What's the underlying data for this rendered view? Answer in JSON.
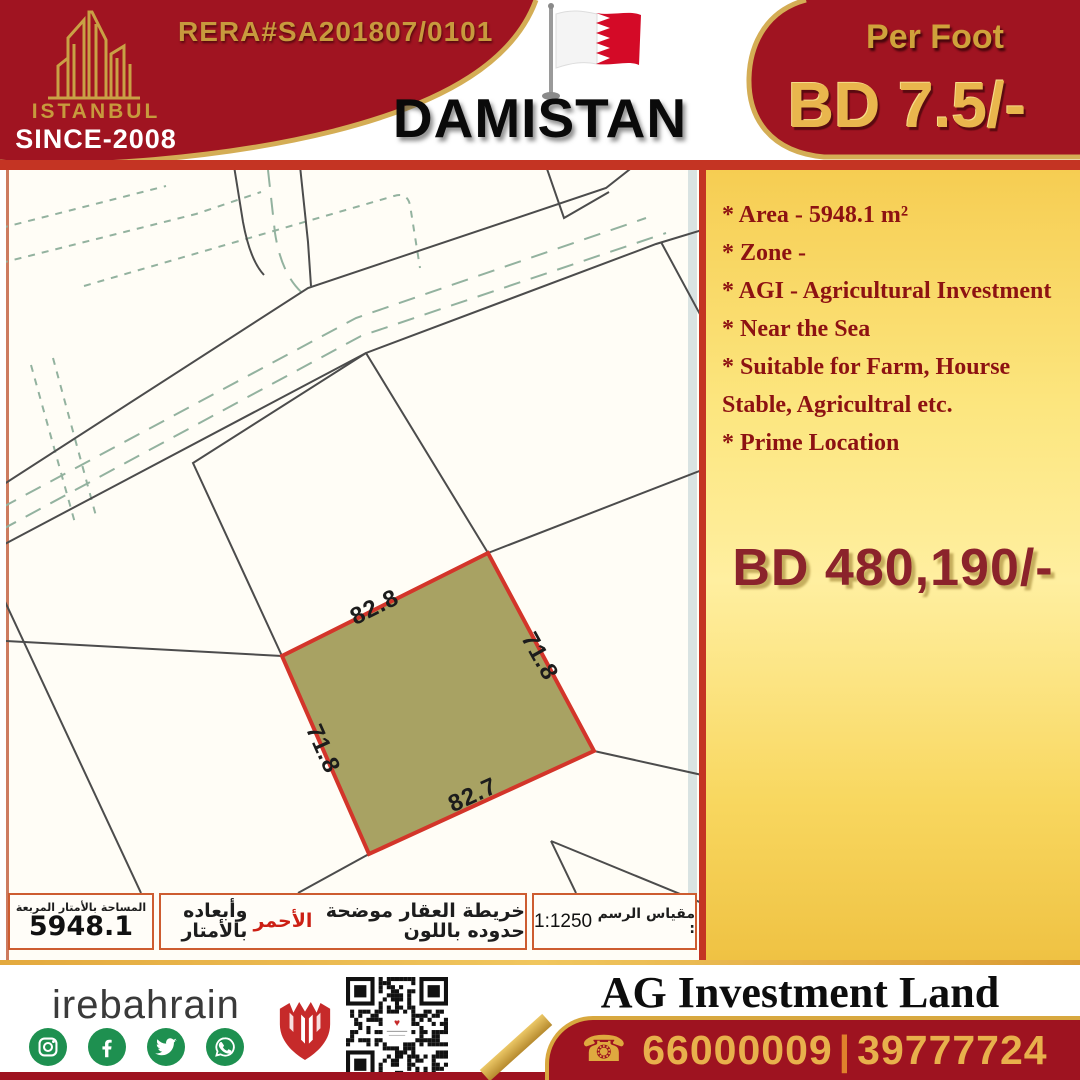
{
  "brand": {
    "logo_icon": "istanbul-skyline-logo",
    "name": "ISTANBUL",
    "since": "SINCE-2008",
    "rera": "RERA#SA201807/0101"
  },
  "header": {
    "flag_icon": "bahrain-flag",
    "location": "DAMISTAN",
    "per_foot_label": "Per Foot",
    "per_foot_price": "BD 7.5/-"
  },
  "details": {
    "bullets": [
      "* Area - 5948.1 m²",
      "* Zone -",
      "* AGI - Agricultural Investment",
      "* Near the Sea",
      "* Suitable for Farm, Hourse",
      "Stable, Agricultral etc.",
      "* Prime Location"
    ],
    "total_price": "BD 480,190/-"
  },
  "map": {
    "plot": {
      "top": "82.8",
      "right": "71.8",
      "left": "71.8",
      "bottom": "82.7"
    },
    "legend": {
      "area_label": "المساحة بالأمتار المربعة",
      "area_value": "5948.1",
      "note_before": "خريطة العقار موضحة حدوده باللون",
      "note_red": "الأحمر",
      "note_after": "وأبعاده بالأمتار",
      "scale_label": "مقياس الرسم :",
      "scale_value": "1:1250"
    }
  },
  "footer": {
    "handle": "irebahrain",
    "social": [
      "instagram",
      "facebook",
      "twitter",
      "whatsapp"
    ],
    "shield_icon": "red-shield-logo",
    "qr_icon": "qr-code",
    "company": "AG Investment Land",
    "phone_icon": "☎",
    "phone1": "66000009",
    "separator": "|",
    "phone2": "39777724"
  },
  "colors": {
    "maroon": "#9e1320",
    "gold": "#c79a3d",
    "panel_yellow": "#fce67f",
    "bullet_red": "#8d1212",
    "plot_fill": "#a8a263",
    "plot_border": "#d3352a",
    "social_green": "#1e9050",
    "table_border": "#cd5c30"
  }
}
